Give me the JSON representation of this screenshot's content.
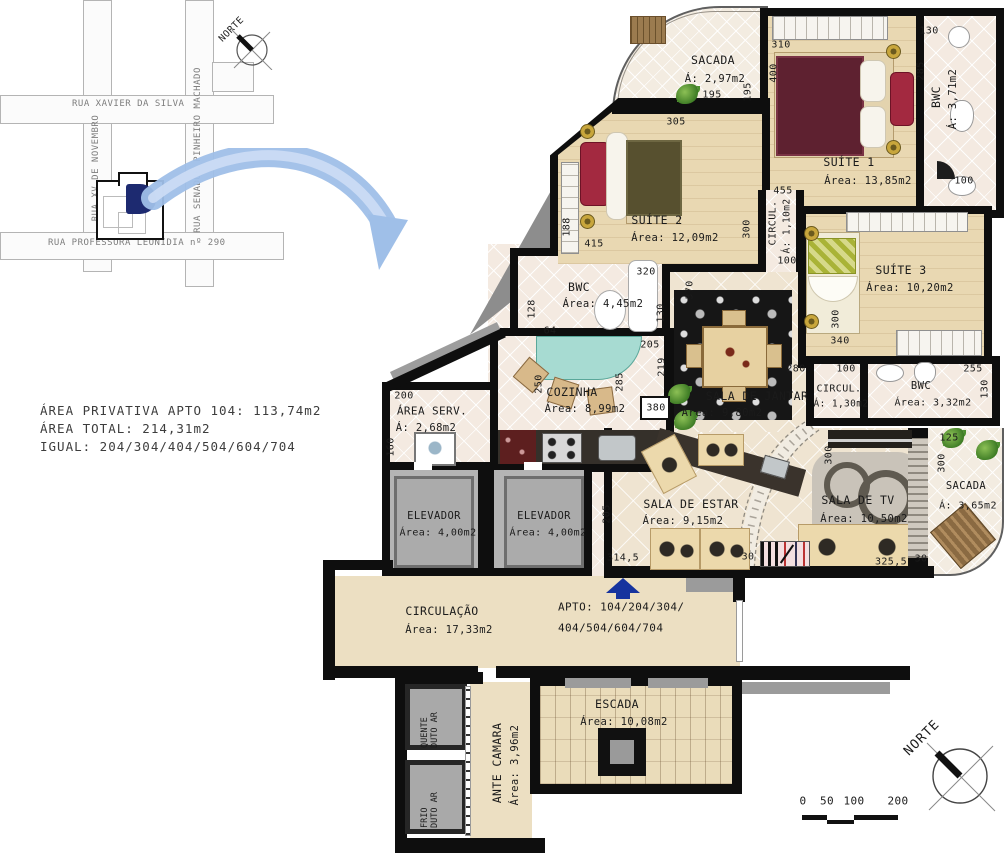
{
  "map": {
    "north": "NORTE",
    "streets": {
      "xavier": "RUA XAVIER DA SILVA",
      "novembro": "RUA XV DE NOVEMBRO",
      "senador": "RUA SENADOR PINHEIRO MACHADO",
      "leonidia": "RUA PROFESSORA LEONÍDIA nº 290"
    }
  },
  "info": {
    "privativa": "ÁREA PRIVATIVA APTO 104: 113,74m2",
    "total": "ÁREA TOTAL: 214,31m2",
    "igual": "IGUAL: 204/304/404/504/604/704"
  },
  "rooms": {
    "sacada_top": {
      "name": "SACADA",
      "area": "Á: 2,97m2"
    },
    "suite1": {
      "name": "SUÍTE 1",
      "area": "Área: 13,85m2"
    },
    "bwc_suite1": {
      "name": "BWC",
      "area": "Á: 3,71m2"
    },
    "suite2": {
      "name": "SUÍTE 2",
      "area": "Área: 12,09m2"
    },
    "circul_110": {
      "name": "CIRCUL.",
      "area": "Á: 1,10m2"
    },
    "suite3": {
      "name": "SUÍTE 3",
      "area": "Área: 10,20m2"
    },
    "bwc_445": {
      "name": "BWC",
      "area": "Área: 4,45m2"
    },
    "circul_130": {
      "name": "CIRCUL.",
      "area": "Á: 1,30m2"
    },
    "bwc_332": {
      "name": "BWC",
      "area": "Área: 3,32m2"
    },
    "cozinha": {
      "name": "COZINHA",
      "area": "Área: 8,99m2"
    },
    "area_serv": {
      "name": "ÁREA SERV.",
      "area": "Á: 2,68m2"
    },
    "jantar": {
      "name": "SALA DE JANTAR",
      "area": "Área: 9,80m2"
    },
    "estar": {
      "name": "SALA DE ESTAR",
      "area": "Área: 9,15m2"
    },
    "tv": {
      "name": "SALA DE TV",
      "area": "Área: 10,50m2"
    },
    "sacada_dir": {
      "name": "SACADA",
      "area": "Á: 3,65m2"
    },
    "elevador1": {
      "name": "ELEVADOR",
      "area": "Área: 4,00m2"
    },
    "elevador2": {
      "name": "ELEVADOR",
      "area": "Área: 4,00m2"
    },
    "circulacao": {
      "name": "CIRCULAÇÃO",
      "area": "Área: 17,33m2"
    },
    "escada": {
      "name": "ESCADA",
      "area": "Área: 10,08m2"
    },
    "ante_camara": {
      "name": "ANTE CAMARA",
      "area": "Área: 3,96m2"
    },
    "duto_quente": {
      "line1": "DUTO AR",
      "line2": "QUENTE"
    },
    "duto_frio": {
      "line1": "DUTO AR",
      "line2": "FRIO"
    }
  },
  "apto": {
    "line1": "APTO: 104/204/304/",
    "line2": "404/504/604/704"
  },
  "dims": [
    "195",
    "195",
    "310",
    "400",
    "455",
    "130",
    "285",
    "100",
    "305",
    "188",
    "415",
    "300",
    "320",
    "370",
    "128",
    "64",
    "130",
    "205",
    "219",
    "285",
    "250",
    "200",
    "160",
    "100",
    "300",
    "340",
    "280",
    "100",
    "255",
    "130",
    "125",
    "300",
    "300",
    "325,5",
    "30",
    "30",
    "205",
    "314,5",
    "380"
  ],
  "scale": {
    "t0": "0",
    "t50": "50",
    "t100": "100",
    "t200": "200"
  },
  "north_plan": "NORTE"
}
